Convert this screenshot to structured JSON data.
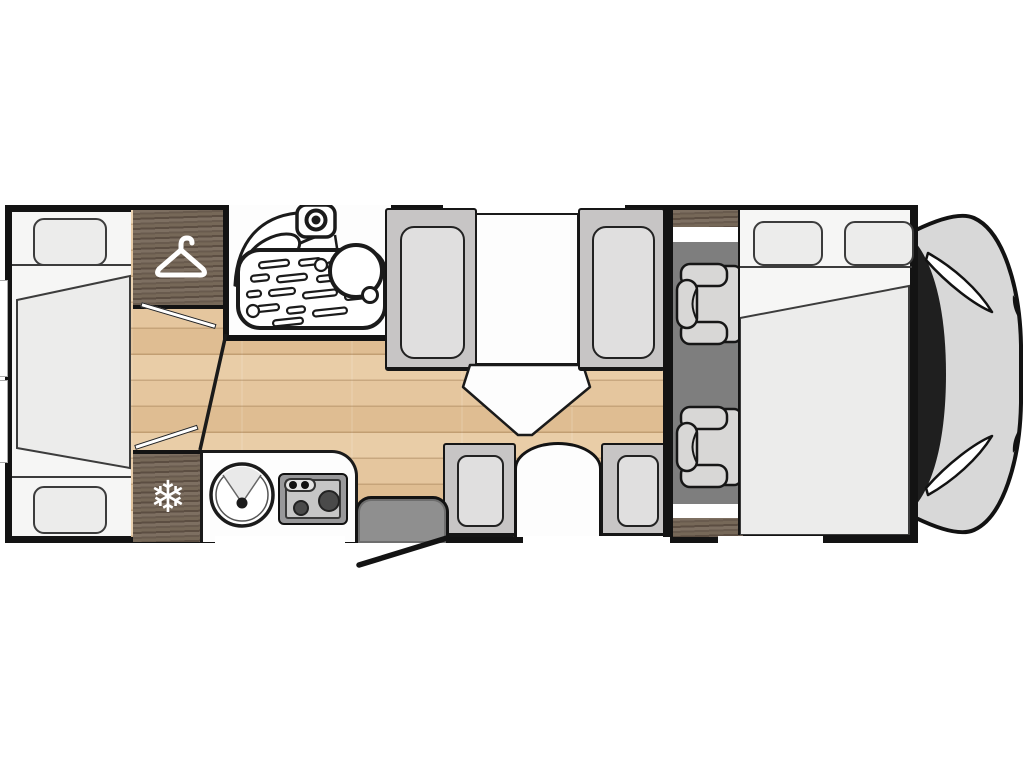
{
  "app": {
    "type": "motorhome-floorplan-diagram"
  },
  "icons": {
    "fridge_snowflake": "❄",
    "wardrobe": "hanger-icon"
  },
  "colors": {
    "wall": "#131313",
    "outline": "#161616",
    "bed_bg": "#f6f6f5",
    "bedding": "#ececeb",
    "bedding_line": "#3c3c3c",
    "seat_frame": "#c7c5c5",
    "seat_cushion": "#e0dfdf",
    "cab_seat": "#d8d7d6",
    "carpet": "#7e7e7e",
    "fixture_white": "#fdfdfd",
    "door_gray": "#8f8f8f",
    "hood_gray": "#d8d8d8",
    "windshield": "#1f1f1f"
  },
  "areas": [
    "rear-french-bed",
    "wardrobe",
    "washroom",
    "corridor-floor",
    "dinette-facing-seats",
    "dinette-table",
    "kitchen-block",
    "fridge",
    "entry-door",
    "cab-swivel-seats",
    "front-drop-down-bed",
    "vehicle-cab-front"
  ]
}
